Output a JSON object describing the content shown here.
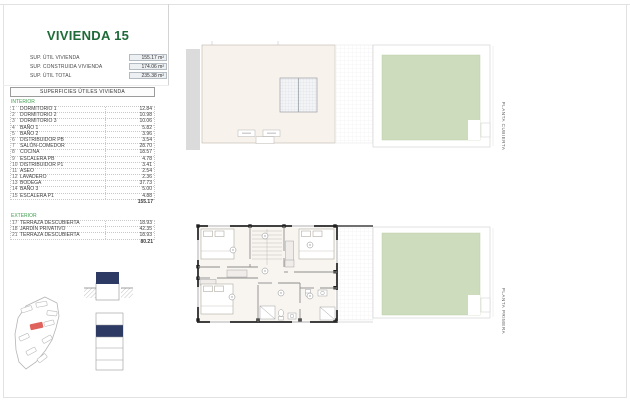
{
  "page": {
    "title": "VIVIENDA 15"
  },
  "summary": {
    "rows": [
      {
        "label": "SUP. ÚTIL VIVIENDA",
        "value": "155.17 m²"
      },
      {
        "label": "SUP. CONSTRUIDA VIVIENDA",
        "value": "174.06 m²"
      },
      {
        "label": "SUP. ÚTIL TOTAL",
        "value": "235.38 m²"
      }
    ]
  },
  "interior_table": {
    "title": "SUPERFICIES ÚTILES VIVIENDA",
    "section": "INTERIOR",
    "rows": [
      {
        "num": "1",
        "label": "DORMITORIO 1",
        "value": "12.84"
      },
      {
        "num": "2",
        "label": "DORMITORIO 2",
        "value": "10.98"
      },
      {
        "num": "3",
        "label": "DORMITORIO 3",
        "value": "10.06"
      },
      {
        "num": "4",
        "label": "BAÑO 1",
        "value": "5.82"
      },
      {
        "num": "5",
        "label": "BAÑO 2",
        "value": "3.96"
      },
      {
        "num": "6",
        "label": "DISTRIBUIDOR PB",
        "value": "3.54"
      },
      {
        "num": "7",
        "label": "SALÓN-COMEDOR",
        "value": "28.70"
      },
      {
        "num": "8",
        "label": "COCINA",
        "value": "18.57"
      },
      {
        "num": "9",
        "label": "ESCALERA PB",
        "value": "4.78"
      },
      {
        "num": "10",
        "label": "DISTRIBUIDOR P1",
        "value": "3.41"
      },
      {
        "num": "11",
        "label": "ASEO",
        "value": "2.54"
      },
      {
        "num": "12",
        "label": "LAVADERO",
        "value": "2.36"
      },
      {
        "num": "13",
        "label": "BODEGA",
        "value": "37.73"
      },
      {
        "num": "14",
        "label": "BAÑO 3",
        "value": "5.00"
      },
      {
        "num": "15",
        "label": "ESCALERA P1",
        "value": "4.88"
      }
    ],
    "total": "155.17"
  },
  "exterior_table": {
    "section": "EXTERIOR",
    "rows": [
      {
        "num": "17",
        "label": "TERRAZA DESCUBIERTA",
        "value": "18.93"
      },
      {
        "num": "18",
        "label": "JARDÍN PRIVATIVO",
        "value": "42.35"
      },
      {
        "num": "21",
        "label": "TERRAZA DESCUBIERTA",
        "value": "18.93"
      }
    ],
    "total": "80.21"
  },
  "plans": {
    "top_label": "PLANTA CUBIERTA",
    "bottom_label": "PLANTA PRIMERA"
  },
  "colors": {
    "accent_green": "#1e6b38",
    "section_green": "#3f9e4d",
    "navy": "#2c3a64",
    "garden_green": "#ccdcbc",
    "roof_fill": "#f7f2ec",
    "plot_red": "#e0625c"
  }
}
